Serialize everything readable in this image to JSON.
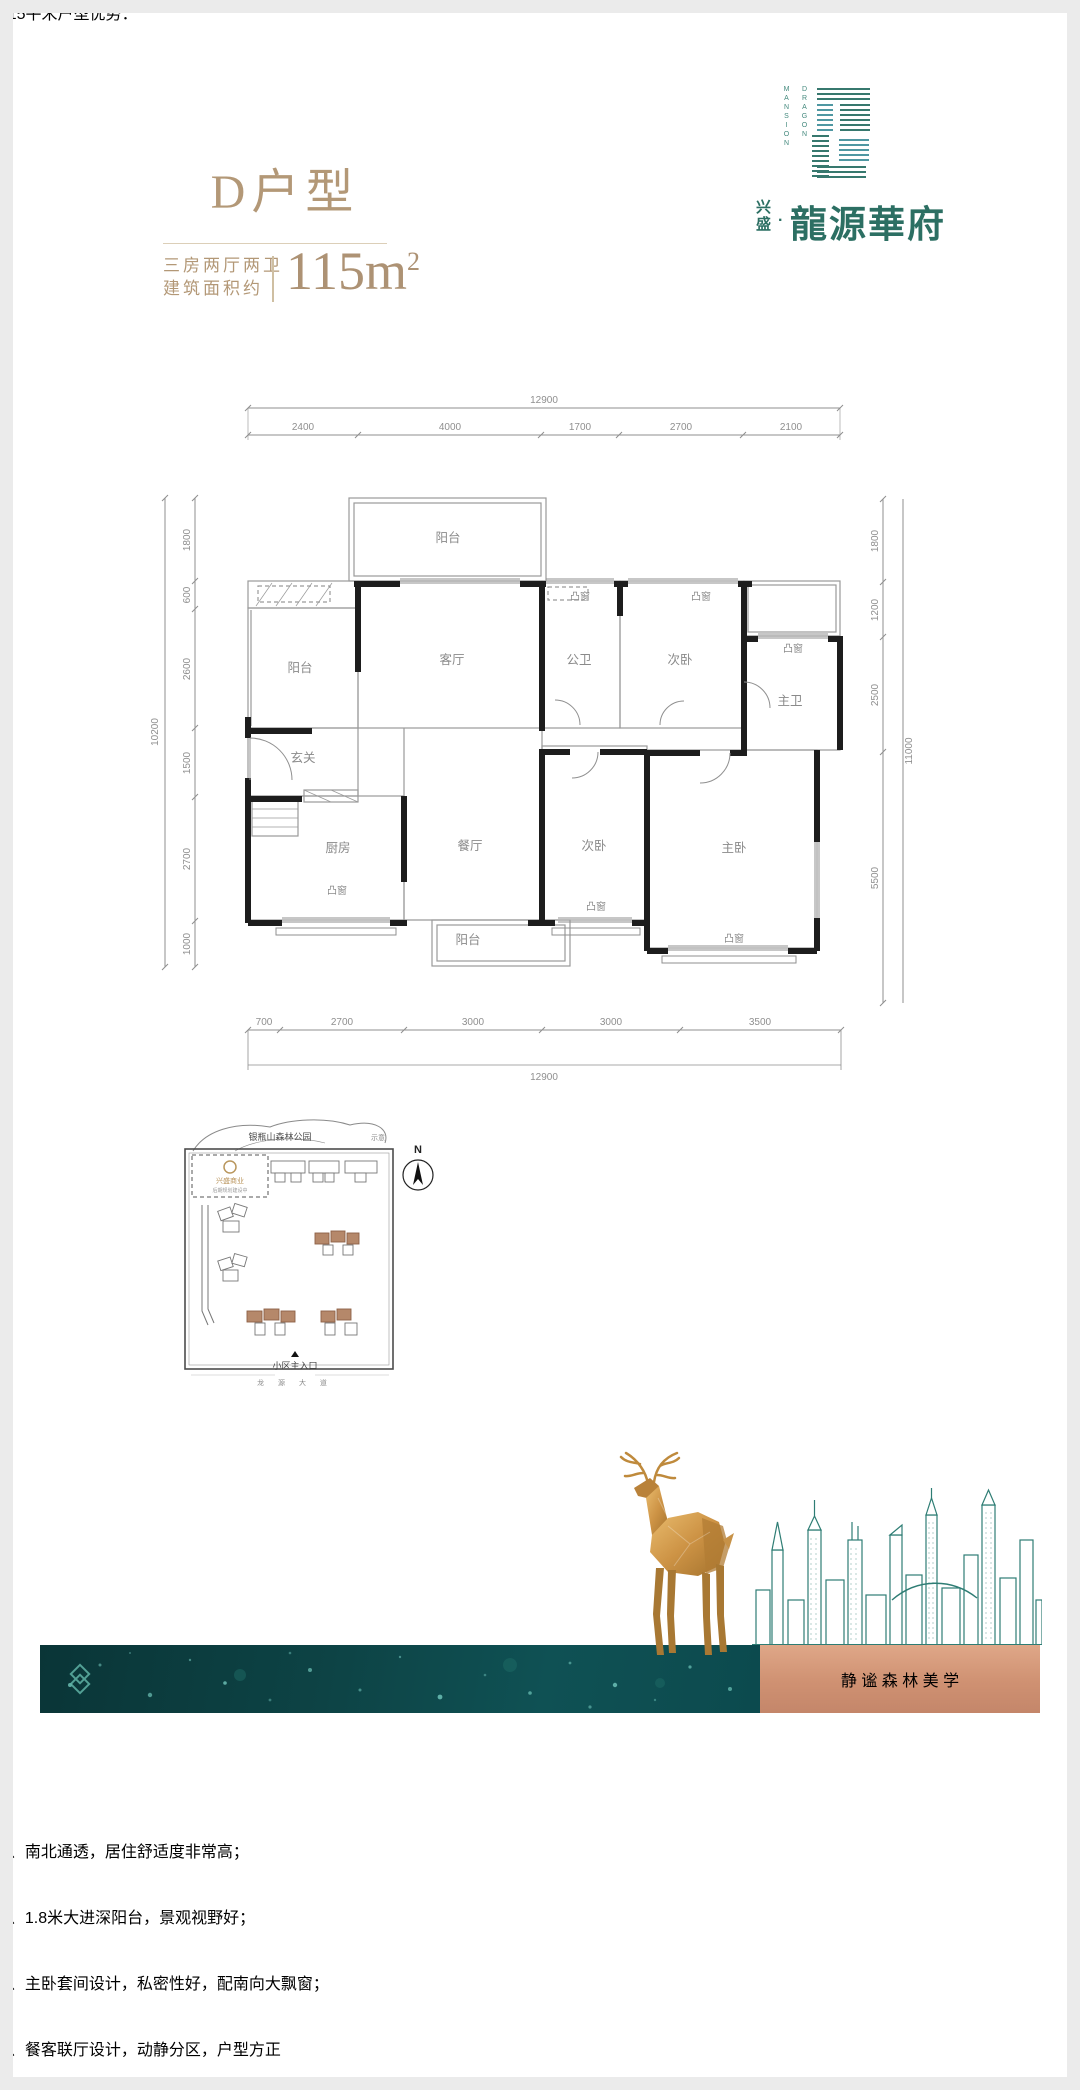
{
  "header": {
    "unit_title": "D户型",
    "spec_line1": "三房两厅两卫",
    "spec_line2": "建筑面积约",
    "area": "115m",
    "area_sup": "2"
  },
  "logo": {
    "en_col_right": "DRAGON",
    "en_col_left": "MANSION",
    "cn_small_1": "兴",
    "cn_small_2": "盛",
    "dot": "·",
    "cn_main": "龍源華府"
  },
  "plan": {
    "labels": {
      "balcony": "阳台",
      "living": "客厅",
      "guest_bath": "公卫",
      "bedroom2": "次卧",
      "master_bath": "主卫",
      "foyer": "玄关",
      "kitchen": "厨房",
      "dining": "餐厅",
      "master": "主卧",
      "bay": "凸窗"
    },
    "dims": {
      "top_total": "12900",
      "top": [
        "2400",
        "4000",
        "1700",
        "2700",
        "2100"
      ],
      "bottom": [
        "700",
        "2700",
        "3000",
        "3000",
        "3500"
      ],
      "bottom_total": "12900",
      "left": [
        "1800",
        "600",
        "2600",
        "1500",
        "2700",
        "1000"
      ],
      "left_total": "10200",
      "right": [
        "1800",
        "1200",
        "2500",
        "5500"
      ],
      "right_total": "11000"
    }
  },
  "siteplan": {
    "park": "银瓶山森林公园",
    "note": "示意",
    "north": "N",
    "parcel": "兴盛商业",
    "parcel_note": "后期规划建设中",
    "entrance": "小区主入口",
    "road": "龙 源 大 道"
  },
  "band": {
    "tagline": "静 谧 森 林 美 学"
  },
  "advantages": {
    "heading": "115平米户型优势：",
    "items": [
      "1、南北通透，居住舒适度非常高；",
      "2、1.8米大进深阳台，景观视野好；",
      "3、主卧套间设计，私密性好，配南向大飘窗；",
      "4、餐客联厅设计，动静分区，户型方正"
    ]
  }
}
